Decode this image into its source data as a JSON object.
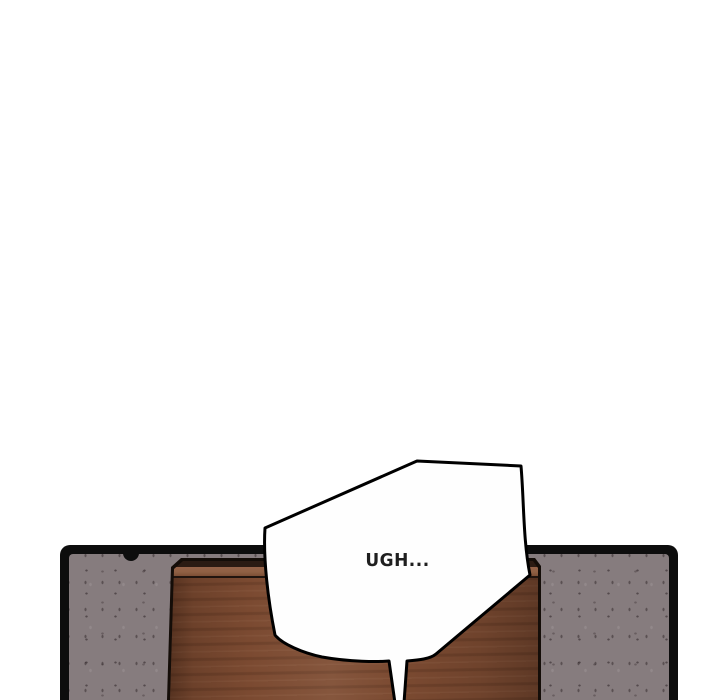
{
  "page": {
    "kind": "webtoon-comic-panel",
    "background": "#ffffff"
  },
  "panel": {
    "description": "comic frame showing a brown wooden door against a speckled gray wall",
    "speech_bubble": {
      "text": "UGH..."
    }
  },
  "theme": {
    "bg": "#ffffff",
    "panel-border": "#0d0d0d",
    "wall": "#867c7e",
    "door-outline": "#140d08",
    "door-face": "#7b4a31",
    "door-band-dark": "#2b1b13",
    "door-band-light": "#8f6044",
    "door-line": "#20140e",
    "bubble-fill": "#fefefe",
    "bubble-stroke": "#000000",
    "text": "#1f1f1f"
  }
}
